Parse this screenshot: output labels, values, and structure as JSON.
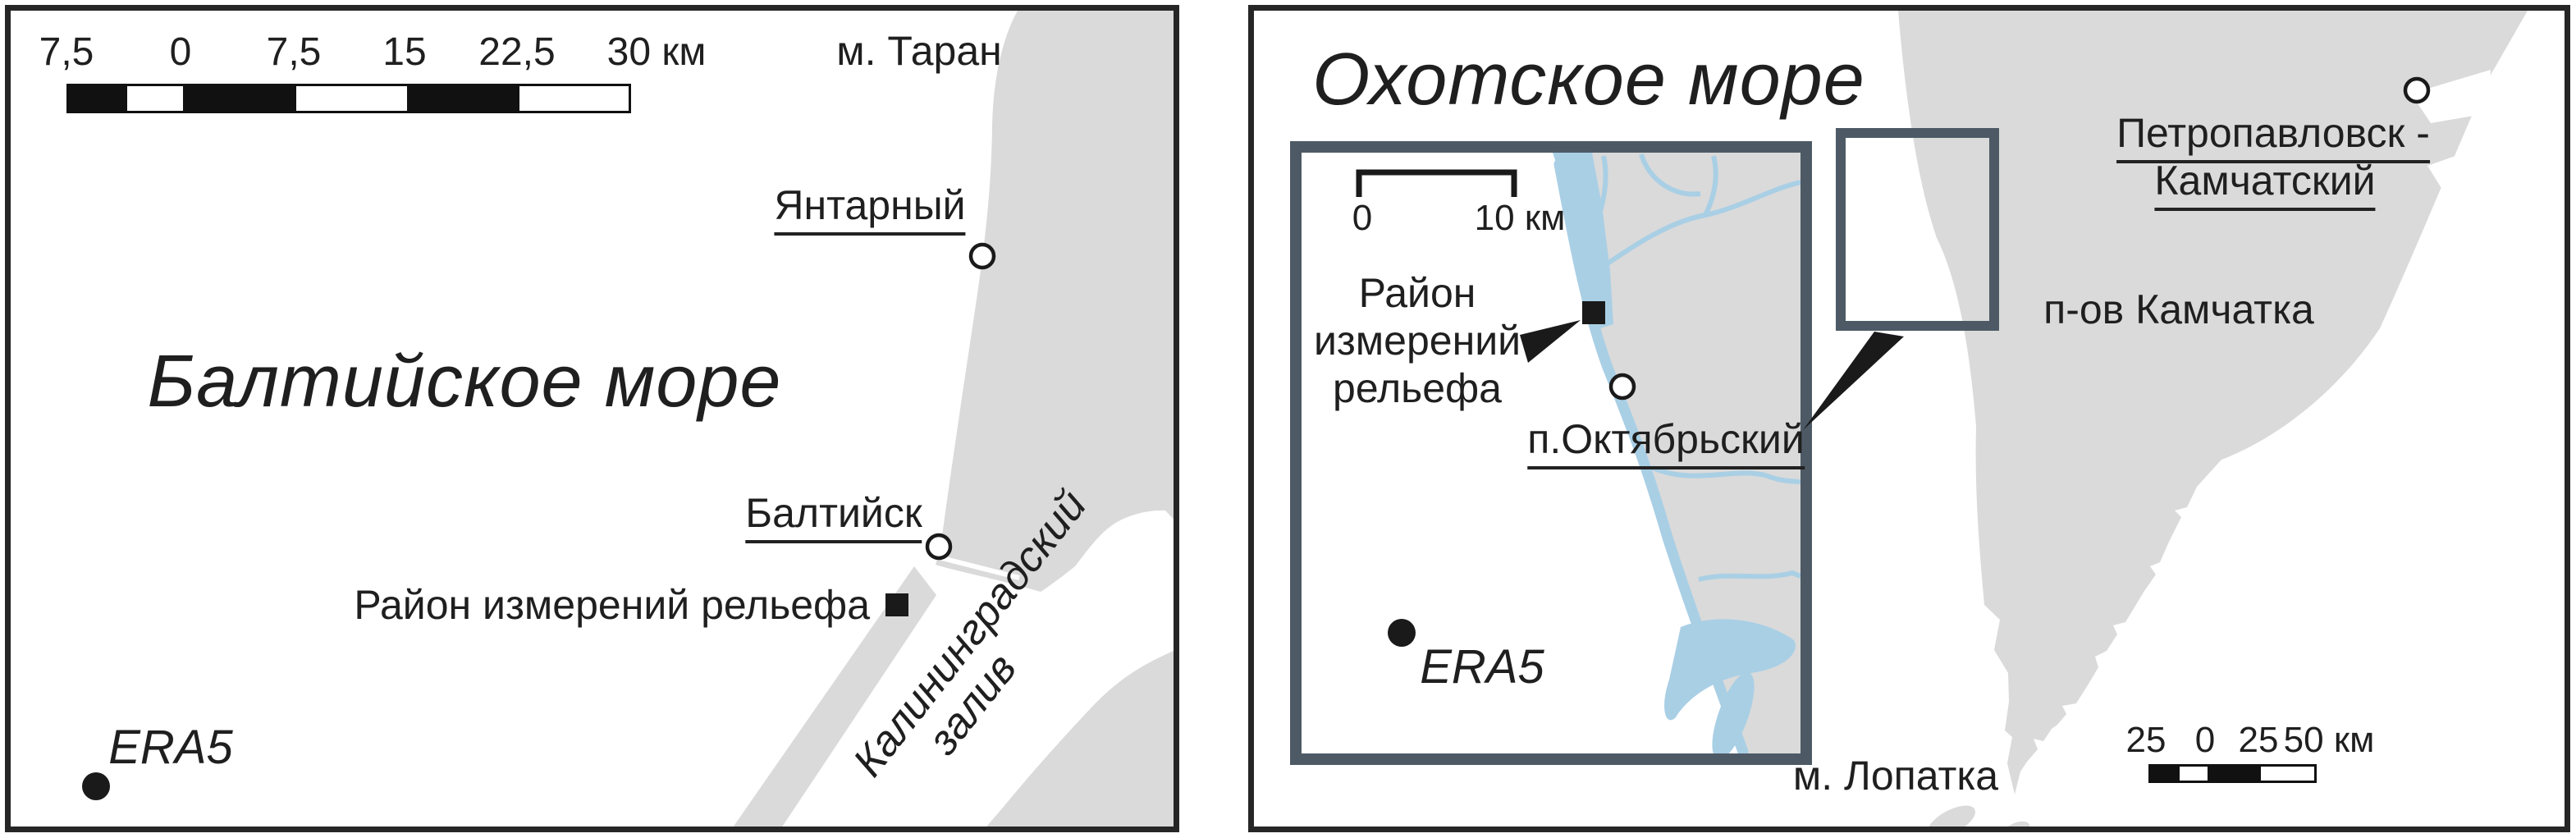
{
  "colors": {
    "land": "#dadada",
    "water": "#a9cfe5",
    "ink": "#1a1a1a",
    "panel_frame": "#262626",
    "inset_frame": "#4d5a66",
    "text": "#1f1f1f"
  },
  "left_map": {
    "sea_title": "Балтийское море",
    "cape_label": "м. Таран",
    "city_yantarny": "Янтарный",
    "city_baltiysk": "Балтийск",
    "survey_area_label": "Район измерений рельефа",
    "bay_label_line1": "Калининградский",
    "bay_label_line2": "залив",
    "era5_label": "ERA5",
    "scalebar": {
      "labels": [
        "7,5",
        "0",
        "7,5",
        "15",
        "22,5",
        "30 км"
      ]
    }
  },
  "right_map": {
    "sea_title": "Охотское море",
    "peninsula_label": "п-ов Камчатка",
    "city_line1": "Петропавловск -",
    "city_line2": "Камчатский",
    "cape_label": "м. Лопатка",
    "scalebar": {
      "labels": [
        "25",
        "0",
        "25",
        "50 км"
      ]
    },
    "inset": {
      "scale_label_0": "0",
      "scale_label_10": "10 км",
      "survey_line1": "Район",
      "survey_line2": "измерений",
      "survey_line3": "рельефа",
      "city": "п.Октябрьский",
      "era5_label": "ERA5"
    }
  }
}
